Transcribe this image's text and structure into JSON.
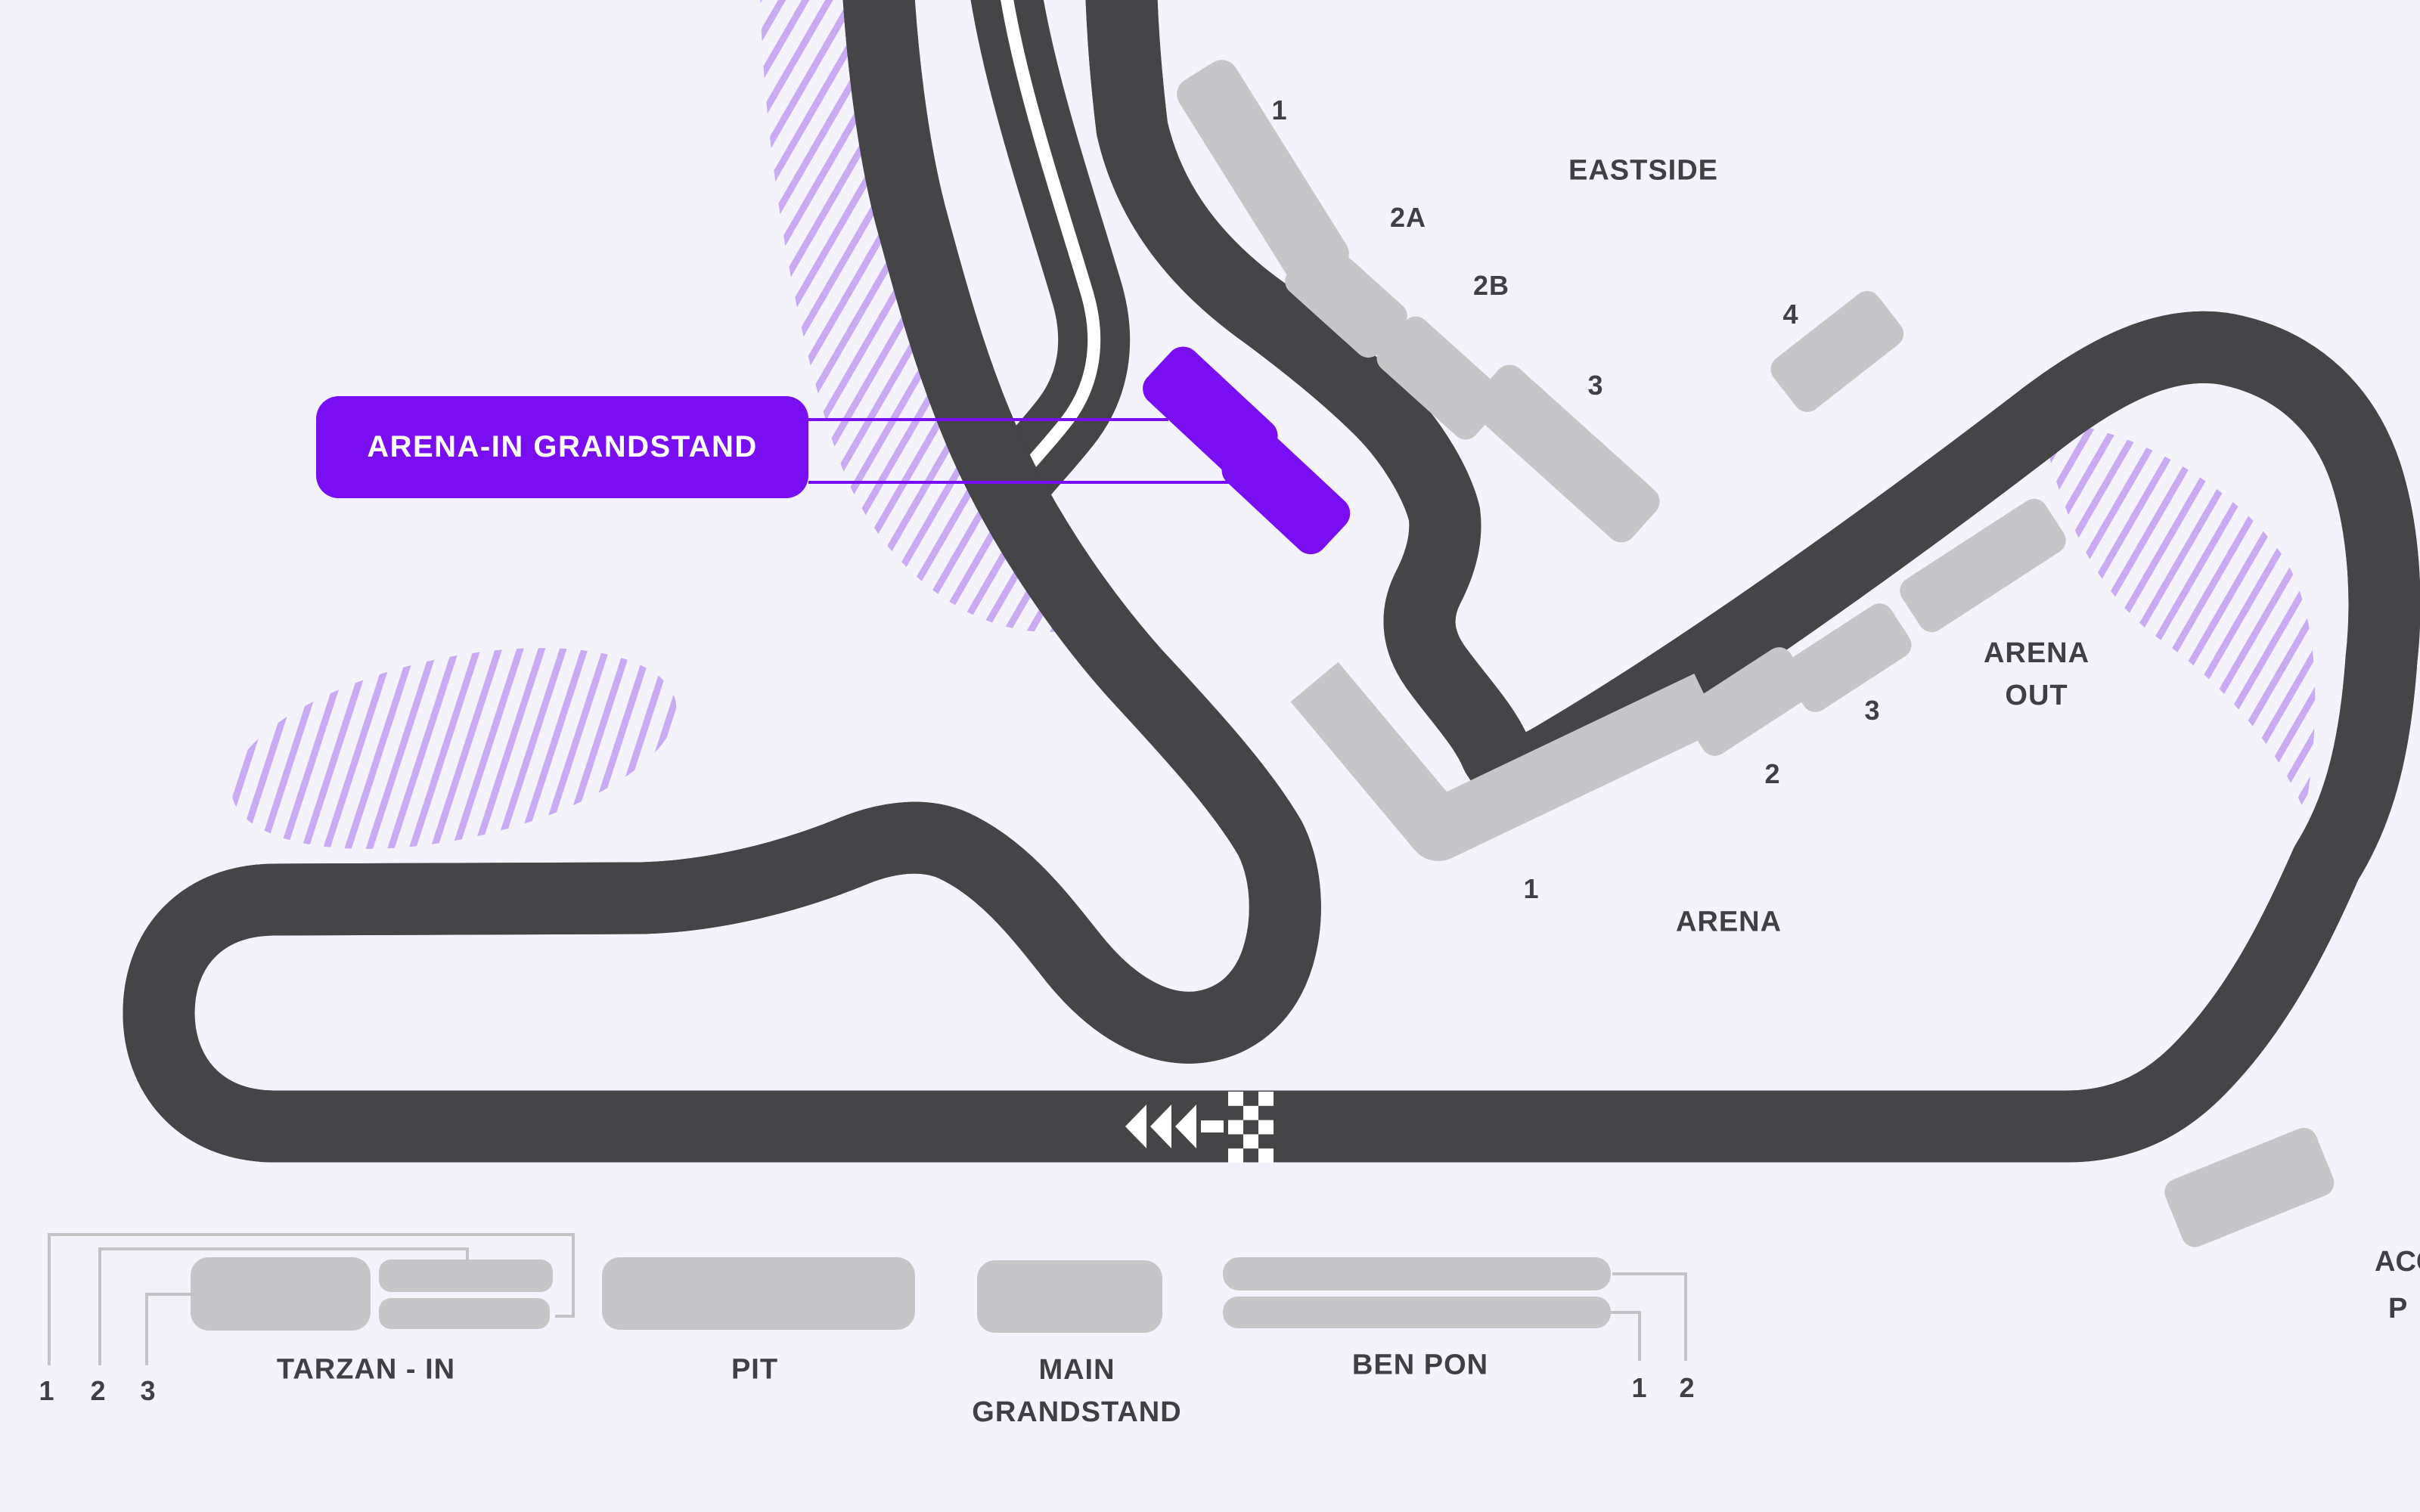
{
  "selection_chip": {
    "label": "ARENA-IN GRANDSTAND"
  },
  "sections": {
    "eastside": {
      "title": "EASTSIDE",
      "stand_labels": {
        "s1": "1",
        "s2a": "2A",
        "s2b": "2B",
        "s3": "3",
        "s4": "4"
      }
    },
    "arena_out": {
      "title_line1": "ARENA",
      "title_line2": "OUT"
    },
    "arena": {
      "title": "ARENA",
      "stand_labels": {
        "s1": "1",
        "s2": "2",
        "s3": "3"
      }
    },
    "tarzan": {
      "title": "TARZAN - IN",
      "callout_labels": {
        "c1": "1",
        "c2": "2",
        "c3": "3"
      }
    },
    "pit": {
      "title": "PIT"
    },
    "main_grandstand": {
      "title_line1": "MAIN",
      "title_line2": "GRANDSTAND"
    },
    "ben_pon": {
      "title": "BEN PON",
      "callout_labels": {
        "c1": "1",
        "c2": "2"
      }
    },
    "edge_clipped_label": {
      "line1": "ACC",
      "line2": "P"
    }
  },
  "track": {
    "start_finish": {
      "direction": "left",
      "marking": "checkered-flag"
    }
  },
  "colors": {
    "background": "#f4f2fb",
    "track": "#454548",
    "track_center_line": "#ffffff",
    "stand": "#c6c6c8",
    "accent": "#7a0ef2",
    "hatch": "#c9abf3",
    "label": "#3f4044",
    "callout_line": "#c3c3c5"
  }
}
